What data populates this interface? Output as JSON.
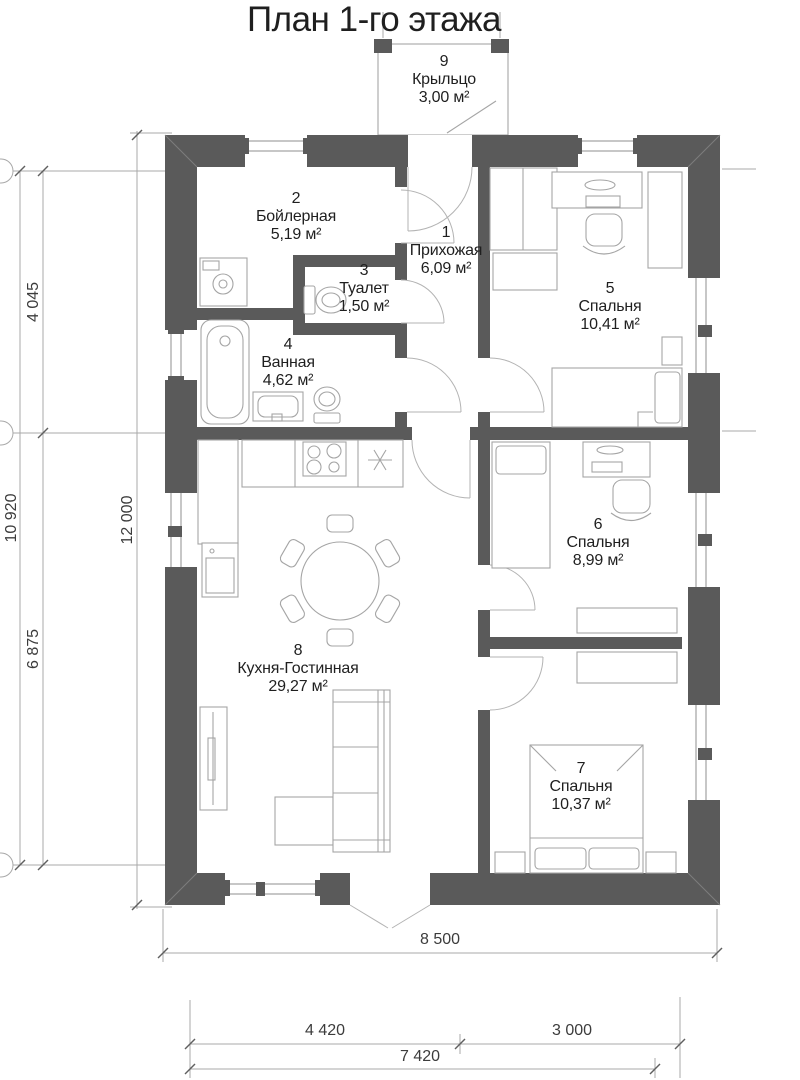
{
  "title": "План 1-го этажа",
  "rooms": [
    {
      "number": "1",
      "name": "Прихожая",
      "area": "6,09 м²"
    },
    {
      "number": "2",
      "name": "Бойлерная",
      "area": "5,19 м²"
    },
    {
      "number": "3",
      "name": "Туалет",
      "area": "1,50 м²"
    },
    {
      "number": "4",
      "name": "Ванная",
      "area": "4,62 м²"
    },
    {
      "number": "5",
      "name": "Спальня",
      "area": "10,41 м²"
    },
    {
      "number": "6",
      "name": "Спальня",
      "area": "8,99 м²"
    },
    {
      "number": "7",
      "name": "Спальня",
      "area": "10,37 м²"
    },
    {
      "number": "8",
      "name": "Кухня-Гостинная",
      "area": "29,27 м²"
    },
    {
      "number": "9",
      "name": "Крыльцо",
      "area": "3,00 м²"
    }
  ],
  "dimensions": {
    "vertical": {
      "outer_total": "12 000",
      "inner_total": "10 920",
      "top_segment": "4 045",
      "bottom_segment": "6 875"
    },
    "horizontal": {
      "total": "8 500",
      "left_segment": "4 420",
      "right_segment": "3 000",
      "inner_total": "7 420"
    }
  },
  "colors": {
    "wall": "#5a5a5a",
    "furniture": "#a5a5a5",
    "dimension": "#a8a8a8",
    "text": "#1f1f1f"
  }
}
